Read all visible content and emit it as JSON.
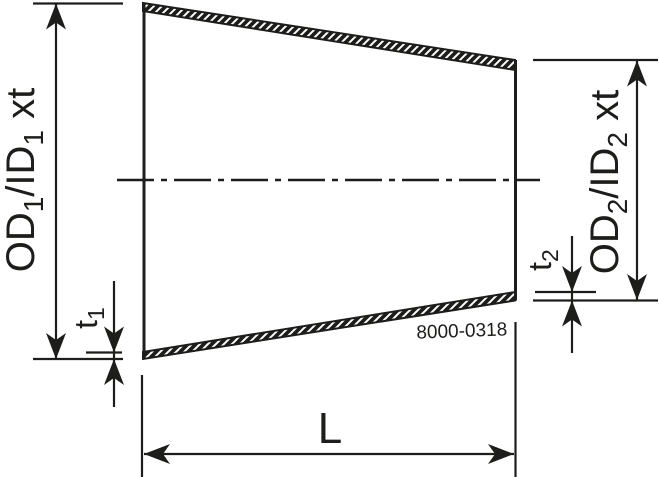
{
  "drawing": {
    "ink_color": "#1d1d1b",
    "background_color": "#ffffff",
    "part_number": "8000-0318",
    "dimensions": {
      "od1": {
        "text1": "OD",
        "sub1": "1",
        "text2": "/ID",
        "sub2": "1",
        "text3": " xt"
      },
      "od2": {
        "text1": "OD",
        "sub1": "2",
        "text2": "/ID",
        "sub2": "2",
        "text3": " xt"
      },
      "t1": {
        "text": "t",
        "sub": "1"
      },
      "t2": {
        "text": "t",
        "sub": "2"
      },
      "length": {
        "text": "L"
      }
    }
  }
}
